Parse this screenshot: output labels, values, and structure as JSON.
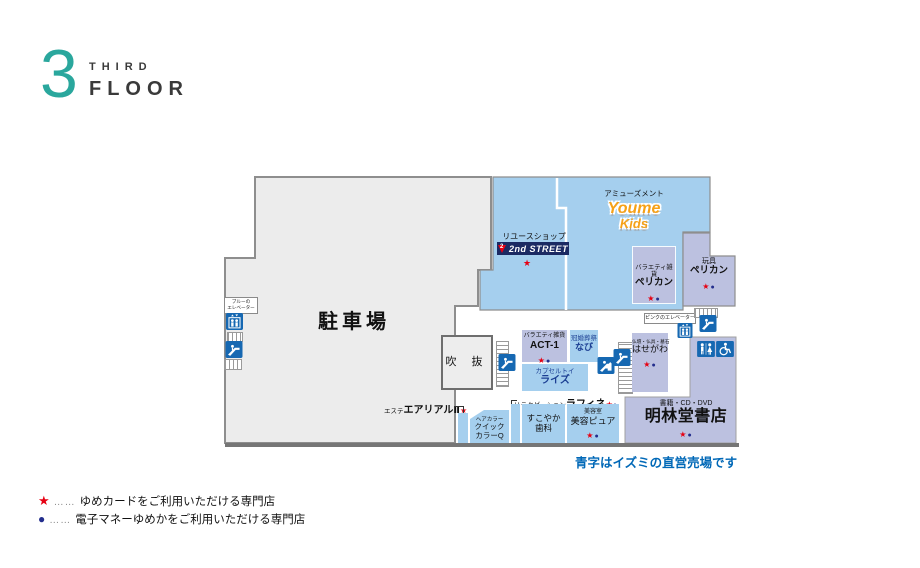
{
  "header": {
    "floor_number": "3",
    "floor_word_line1": "THIRD",
    "floor_word_line2": "FLOOR"
  },
  "symbols": {
    "star": "★",
    "dot": "●"
  },
  "map": {
    "parking": "駐車場",
    "atrium": "吹 抜",
    "blue_elevator_line1": "ブルーの",
    "blue_elevator_line2": "エレベーター",
    "pink_elevator": "ピンクのエレベーター",
    "note": "青字はイズミの直営売場です"
  },
  "stores": {
    "second_street": {
      "category": "リユースショップ",
      "name": "2nd STREET",
      "mark": "2"
    },
    "youme_kids": {
      "category": "アミューズメント",
      "line1": "Youme",
      "line2": "Kids"
    },
    "pelican_variety": {
      "category": "バラエティ雑貨",
      "name": "ペリカン"
    },
    "pelican_toy": {
      "category": "玩具",
      "name": "ペリカン"
    },
    "act1": {
      "category": "バラエティ雑貨",
      "name": "ACT-1"
    },
    "navi": {
      "category": "冠婚葬祭",
      "name": "なび"
    },
    "rise": {
      "category": "カプセルトイ",
      "name": "ライズ"
    },
    "hasegawa": {
      "category": "仏壇・仏具・墓石",
      "name": "はせがわ"
    },
    "aerial": {
      "category": "エステ",
      "name": "エアリアルⅡ"
    },
    "quick_color": {
      "category": "ヘアカラー",
      "line1": "クイック",
      "line2": "カラーQ"
    },
    "raffine": {
      "category": "リラクゼーション",
      "name": "ラフィネ"
    },
    "sukoyaka": {
      "line1": "すこやか",
      "line2": "歯科"
    },
    "pure": {
      "category": "美容室",
      "name": "美容ピュア"
    },
    "meirindo": {
      "category": "書籍・CD・DVD",
      "name": "明林堂書店"
    }
  },
  "legend": {
    "leader": "……",
    "star_text": "ゆめカードをご利用いただける専門店",
    "dot_text": "電子マネーゆめかをご利用いただける専門店"
  }
}
